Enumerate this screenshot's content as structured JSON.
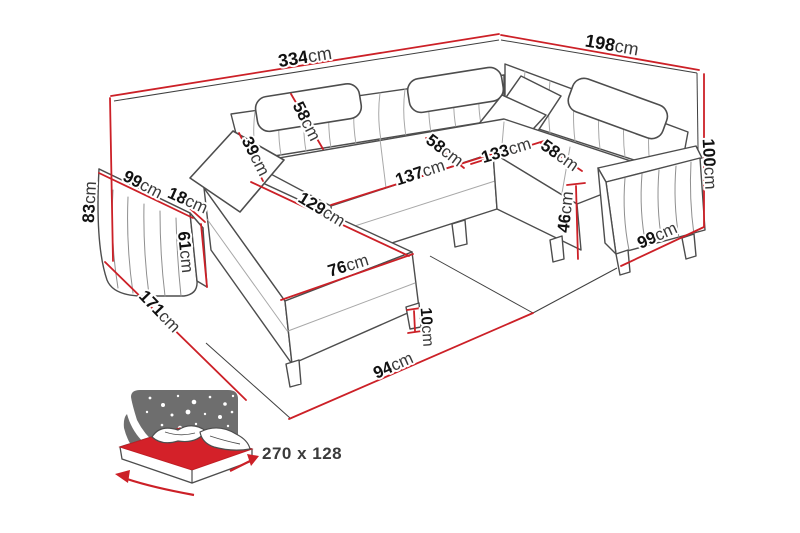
{
  "diagram": {
    "title": "corner-sofa-dimension-diagram",
    "unit": "cm",
    "colors": {
      "dimension_line": "#cc2027",
      "sofa_outline": "#4d4d4d",
      "box_line": "#3f3f3f",
      "icon_background": "#6e6e6e",
      "mattress_red": "#d42129",
      "label_number": "#111111",
      "label_unit": "#3a3a3a"
    },
    "labels": [
      {
        "id": "total-width",
        "text": "334cm",
        "x": 305,
        "y": 57,
        "rot": -9,
        "size": 18
      },
      {
        "id": "total-depth",
        "text": "198cm",
        "x": 612,
        "y": 45,
        "rot": 10,
        "size": 18
      },
      {
        "id": "height-left",
        "text": "83cm",
        "x": 89,
        "y": 202,
        "rot": -87,
        "size": 17
      },
      {
        "id": "arm-left-length",
        "text": "99cm",
        "x": 143,
        "y": 184,
        "rot": 27,
        "size": 17
      },
      {
        "id": "arm-left-width",
        "text": "18cm",
        "x": 188,
        "y": 200,
        "rot": 24,
        "size": 17
      },
      {
        "id": "arm-left-height",
        "text": "61cm",
        "x": 186,
        "y": 252,
        "rot": 84,
        "size": 17
      },
      {
        "id": "chaise-depth",
        "text": "171cm",
        "x": 160,
        "y": 311,
        "rot": 46,
        "size": 17
      },
      {
        "id": "back-cushion-width",
        "text": "39cm",
        "x": 256,
        "y": 156,
        "rot": 63,
        "size": 17
      },
      {
        "id": "backrest-height",
        "text": "58cm",
        "x": 307,
        "y": 121,
        "rot": 63,
        "size": 17
      },
      {
        "id": "chaise-length",
        "text": "129cm",
        "x": 322,
        "y": 209,
        "rot": 31,
        "size": 17
      },
      {
        "id": "chaise-width",
        "text": "76cm",
        "x": 348,
        "y": 265,
        "rot": -17,
        "size": 17
      },
      {
        "id": "middle-seat-length",
        "text": "137cm",
        "x": 420,
        "y": 172,
        "rot": -18,
        "size": 17
      },
      {
        "id": "middle-seat-depth",
        "text": "58cm",
        "x": 445,
        "y": 150,
        "rot": 37,
        "size": 17
      },
      {
        "id": "right-back-length",
        "text": "133cm",
        "x": 506,
        "y": 150,
        "rot": -17,
        "size": 17
      },
      {
        "id": "right-seat-depth",
        "text": "58cm",
        "x": 560,
        "y": 155,
        "rot": 35,
        "size": 17
      },
      {
        "id": "seat-height",
        "text": "46cm",
        "x": 565,
        "y": 212,
        "rot": -84,
        "size": 17
      },
      {
        "id": "height-right",
        "text": "100cm",
        "x": 710,
        "y": 164,
        "rot": 87,
        "size": 17
      },
      {
        "id": "arm-right-depth",
        "text": "99cm",
        "x": 657,
        "y": 235,
        "rot": -24,
        "size": 17
      },
      {
        "id": "leg-height",
        "text": "10cm",
        "x": 427,
        "y": 327,
        "rot": 86,
        "size": 16
      },
      {
        "id": "floor-front",
        "text": "94cm",
        "x": 393,
        "y": 365,
        "rot": -24,
        "size": 17
      }
    ],
    "sleeping_area": {
      "label": "270 x 128"
    }
  }
}
